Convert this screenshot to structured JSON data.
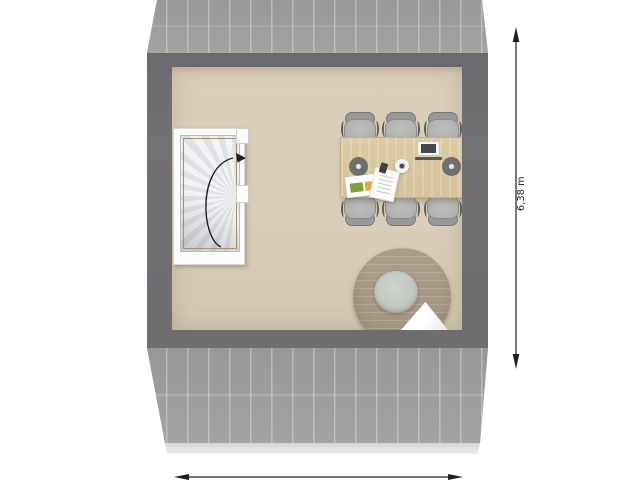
{
  "plan": {
    "kind": "floor-plan-top-view",
    "annotations": {
      "vertical_dimension": {
        "label": "6,38 m",
        "arrow": "double-headed-vertical"
      },
      "horizontal_dimension": {
        "arrow": "double-headed-horizontal"
      },
      "stair_direction": {
        "arrow": "curved-arc-clockwise-up"
      }
    },
    "rooms": {
      "main_room_floor": "beige",
      "stairwell": "spiral-staircase"
    },
    "furniture": {
      "staircase": "spiral-staircase",
      "table": "dining-table",
      "chairs_count": 6,
      "lounge_chair": "round-lounge-chair-with-cushion-and-blanket"
    },
    "table_items": [
      "laptop",
      "bowl",
      "placemat-left",
      "placemat-right",
      "brochure",
      "paper-sheet",
      "phone"
    ],
    "colors": {
      "roof_gray": "#9c9c9a",
      "roof_plank_line": "#b5b5b3",
      "wall_dark": "#6f6e71",
      "floor_beige": "#d9cdb9",
      "stair_frame_white": "#fbfbfa",
      "stair_step_light": "#f2f2f4",
      "stair_step_shade": "#dfe0e3",
      "railing_tan": "#a3926f",
      "table_wood": "#d8c59e",
      "chair_gray": "#b4b4b2",
      "chair_back_gray": "#99999a",
      "lounge_taupe": "#a79a88",
      "cushion_sage": "#c6ccc7",
      "blanket_white": "#f4f4f2",
      "brochure_green": "#7ba23f",
      "brochure_yellow": "#e2a93d",
      "annotation_black": "#1f1f1f"
    }
  }
}
